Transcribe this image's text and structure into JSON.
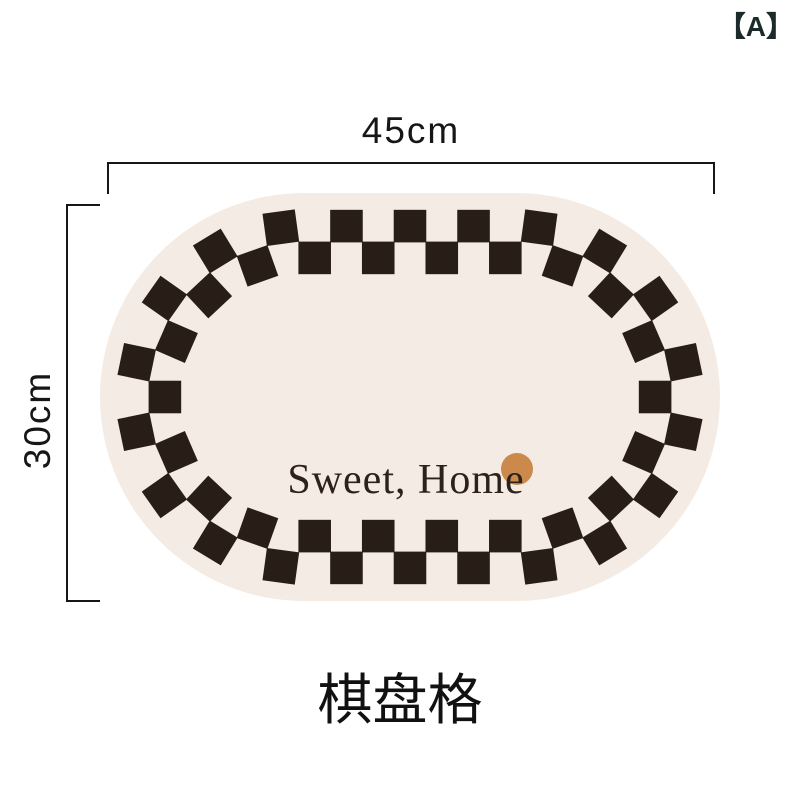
{
  "product": {
    "variant_label": "【A】",
    "caption": "棋盘格",
    "width_dimension": "45cm",
    "height_dimension": "30cm"
  },
  "mat": {
    "text": "Sweet, Home",
    "base_color": "#f4ebe4",
    "checker_color": "#281d17",
    "text_color": "#2e2119",
    "dot_color": "#cb8a4c",
    "geometry": {
      "width": 620,
      "height": 408,
      "corner_radius": 204,
      "band_mid_offset": 49,
      "cells": 44,
      "rows": 2,
      "dot": {
        "x": 417,
        "y": 276,
        "r": 16
      },
      "text_pos": {
        "x": 306,
        "y": 300,
        "font_size": 42
      }
    }
  },
  "colors": {
    "page_bg": "#ffffff",
    "dimension_ink": "#161616",
    "variant_ink": "#1c2a2b"
  }
}
